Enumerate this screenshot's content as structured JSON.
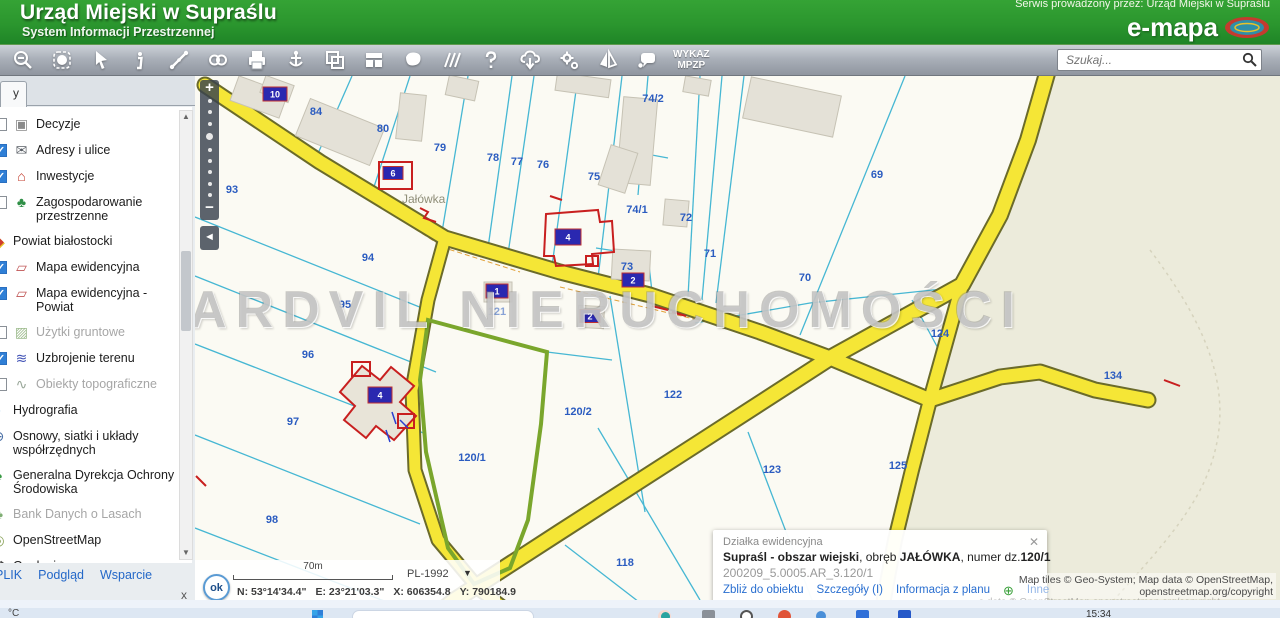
{
  "header": {
    "title": "Urząd Miejski w Supraślu",
    "subtitle": "System Informacji Przestrzennej",
    "service_note": "Serwis prowadzony przez: Urząd Miejski w Supraślu",
    "brand": "e-mapa"
  },
  "toolbar": {
    "icons": [
      "zoom-out",
      "select-area",
      "cursor",
      "info",
      "measure",
      "link",
      "print",
      "locate",
      "copy-frames",
      "layout",
      "area-shape",
      "guides",
      "help",
      "cloud-download",
      "settings",
      "compare",
      "feedback"
    ],
    "wykaz_line1": "WYKAZ",
    "wykaz_line2": "MPZP",
    "search_placeholder": "Szukaj..."
  },
  "sidebar": {
    "tab_label": "y",
    "layers": [
      {
        "label": "Decyzje",
        "cb_class": "unchecked",
        "row_class": "",
        "label_class": "",
        "glyph": "▣",
        "icon_style": "color:#8a8a8a"
      },
      {
        "label": "Adresy i ulice",
        "cb_class": "checked",
        "row_class": "",
        "label_class": "",
        "glyph": "✉",
        "icon_style": "color:#5a5f66"
      },
      {
        "label": "Inwestycje",
        "cb_class": "checked",
        "row_class": "",
        "label_class": "",
        "glyph": "⌂",
        "icon_style": "color:#c23a2a"
      },
      {
        "label": "Zagospodarowanie przestrzenne",
        "cb_class": "unchecked",
        "row_class": "",
        "label_class": "",
        "glyph": "♣",
        "icon_style": "color:#2f8f46"
      },
      {
        "label": "Powiat białostocki",
        "cb_class": "",
        "row_class": "nocb",
        "label_class": "",
        "glyph": "◆",
        "icon_style": "color:#cf3b2e;text-shadow:1px 1px 0 #e8c22a"
      },
      {
        "label": "Mapa ewidencyjna",
        "cb_class": "checked",
        "row_class": "",
        "label_class": "",
        "glyph": "▱",
        "icon_style": "color:#c05555"
      },
      {
        "label": "Mapa ewidencyjna - Powiat",
        "cb_class": "checked",
        "row_class": "",
        "label_class": "",
        "glyph": "▱",
        "icon_style": "color:#c05555"
      },
      {
        "label": "Użytki gruntowe",
        "cb_class": "unchecked",
        "row_class": "",
        "label_class": "dim",
        "glyph": "▨",
        "icon_style": "color:#9dbb8d"
      },
      {
        "label": "Uzbrojenie terenu",
        "cb_class": "checked",
        "row_class": "",
        "label_class": "",
        "glyph": "≋",
        "icon_style": "color:#3f51b5"
      },
      {
        "label": "Obiekty topograficzne",
        "cb_class": "unchecked",
        "row_class": "",
        "label_class": "dim",
        "glyph": "∿",
        "icon_style": "color:#9aa89a"
      },
      {
        "label": "Hydrografia",
        "cb_class": "",
        "row_class": "nocb",
        "label_class": "",
        "glyph": "◗",
        "icon_style": "color:#2e86d0"
      },
      {
        "label": "Osnowy, siatki i układy współrzędnych",
        "cb_class": "",
        "row_class": "nocb",
        "label_class": "",
        "glyph": "⊕",
        "icon_style": "color:#4a6fa5"
      },
      {
        "label": "Generalna Dyrekcja Ochrony Środowiska",
        "cb_class": "",
        "row_class": "nocb",
        "label_class": "",
        "glyph": "♠",
        "icon_style": "color:#3a9a45"
      },
      {
        "label": "Bank Danych o Lasach",
        "cb_class": "",
        "row_class": "nocb",
        "label_class": "dim",
        "glyph": "♣",
        "icon_style": "color:#7fae74"
      },
      {
        "label": "OpenStreetMap",
        "cb_class": "",
        "row_class": "nocb",
        "label_class": "",
        "glyph": "◎",
        "icon_style": "color:#8aa35a"
      },
      {
        "label": "Geologia",
        "cb_class": "",
        "row_class": "nocb",
        "label_class": "",
        "glyph": "⚒",
        "icon_style": "color:#4a4a4a"
      },
      {
        "label": "Narodowy Instytut Dziedzictwa",
        "cb_class": "",
        "row_class": "nocb",
        "label_class": "",
        "glyph": "◉",
        "icon_style": "color:#c22d3e"
      }
    ],
    "footer_links": [
      {
        "label": "PLIK"
      },
      {
        "label": "Podgląd"
      },
      {
        "label": "Wsparcie"
      }
    ],
    "close_label": "x"
  },
  "map": {
    "locality_label": "Jałówka",
    "watermark": "ARDVIL NIERUCHOMOŚCI",
    "parcel_labels": [
      {
        "t": "93",
        "x": 232,
        "y": 193
      },
      {
        "t": "94",
        "x": 368,
        "y": 261
      },
      {
        "t": "95",
        "x": 345,
        "y": 308
      },
      {
        "t": "96",
        "x": 308,
        "y": 358
      },
      {
        "t": "97",
        "x": 293,
        "y": 425
      },
      {
        "t": "98",
        "x": 272,
        "y": 523
      },
      {
        "t": "84",
        "x": 316,
        "y": 115
      },
      {
        "t": "80",
        "x": 383,
        "y": 132
      },
      {
        "t": "79",
        "x": 440,
        "y": 151
      },
      {
        "t": "78",
        "x": 493,
        "y": 161
      },
      {
        "t": "77",
        "x": 517,
        "y": 165
      },
      {
        "t": "76",
        "x": 543,
        "y": 168
      },
      {
        "t": "75",
        "x": 594,
        "y": 180
      },
      {
        "t": "74/2",
        "x": 653,
        "y": 102
      },
      {
        "t": "74/1",
        "x": 637,
        "y": 213
      },
      {
        "t": "72",
        "x": 686,
        "y": 221
      },
      {
        "t": "71",
        "x": 710,
        "y": 257
      },
      {
        "t": "73",
        "x": 627,
        "y": 270
      },
      {
        "t": "70",
        "x": 805,
        "y": 281
      },
      {
        "t": "69",
        "x": 877,
        "y": 178
      },
      {
        "t": "121",
        "x": 497,
        "y": 315,
        "dim": true
      },
      {
        "t": "122",
        "x": 673,
        "y": 398
      },
      {
        "t": "120/2",
        "x": 578,
        "y": 415
      },
      {
        "t": "120/1",
        "x": 472,
        "y": 461
      },
      {
        "t": "123",
        "x": 772,
        "y": 473
      },
      {
        "t": "125",
        "x": 898,
        "y": 469
      },
      {
        "t": "124",
        "x": 940,
        "y": 337
      },
      {
        "t": "134",
        "x": 1113,
        "y": 379
      },
      {
        "t": "118",
        "x": 625,
        "y": 566
      }
    ],
    "address_markers": [
      {
        "t": "10",
        "x": 275,
        "y": 94,
        "w": 24,
        "h": 14
      },
      {
        "t": "6",
        "x": 393,
        "y": 173,
        "w": 20,
        "h": 13
      },
      {
        "t": "4",
        "x": 568,
        "y": 237,
        "w": 26,
        "h": 16
      },
      {
        "t": "2",
        "x": 633,
        "y": 280,
        "w": 22,
        "h": 14
      },
      {
        "t": "1",
        "x": 497,
        "y": 291,
        "w": 22,
        "h": 14
      },
      {
        "t": "2",
        "x": 590,
        "y": 316,
        "w": 20,
        "h": 13
      },
      {
        "t": "4",
        "x": 380,
        "y": 395,
        "w": 24,
        "h": 16
      }
    ],
    "scalebar_label": "70m",
    "crs": "PL-1992",
    "ok_label": "ok",
    "coords": {
      "n": "N: 53°14'34.4\"",
      "e": "E: 23°21'03.3\"",
      "x": "X: 606354.8",
      "y": "Y: 790184.9"
    },
    "popup": {
      "title": "Działka ewidencyjna",
      "bold1": "Supraśl - obszar wiejski",
      "sep1": ", obręb ",
      "bold2": "JAŁÓWKA",
      "sep2": ", numer dz.",
      "bold3": "120/1",
      "id_line": "200209_5.0005.AR_3.120/1",
      "links": [
        "Zbliż do obiektu",
        "Szczegóły (I)",
        "Informacja z planu"
      ],
      "plus_glyph": "⊕",
      "link_last": "Inne",
      "close_glyph": "✕"
    },
    "attribution_line1": "Map tiles © Geo-System; Map data © OpenStreetMap,",
    "attribution_line2": "openstreetmap.org/copyright",
    "attribution_faint": "a data © OpenStreetMap openstreetmap.org/copyright"
  },
  "taskbar": {
    "weather_fragment": "°C",
    "time": "15:34"
  },
  "colors": {
    "header_green": "#2b962e",
    "road_yellow": "#f5e636",
    "road_casing": "#6b6b2a",
    "parcel_line": "#46b7d3",
    "selected_parcel_green": "#7aa62c",
    "parcel_label_blue": "#2b5cc0",
    "marker_blue": "#2a28b0",
    "link_blue": "#2a6fd0",
    "osm_beige": "#ecebdb"
  }
}
